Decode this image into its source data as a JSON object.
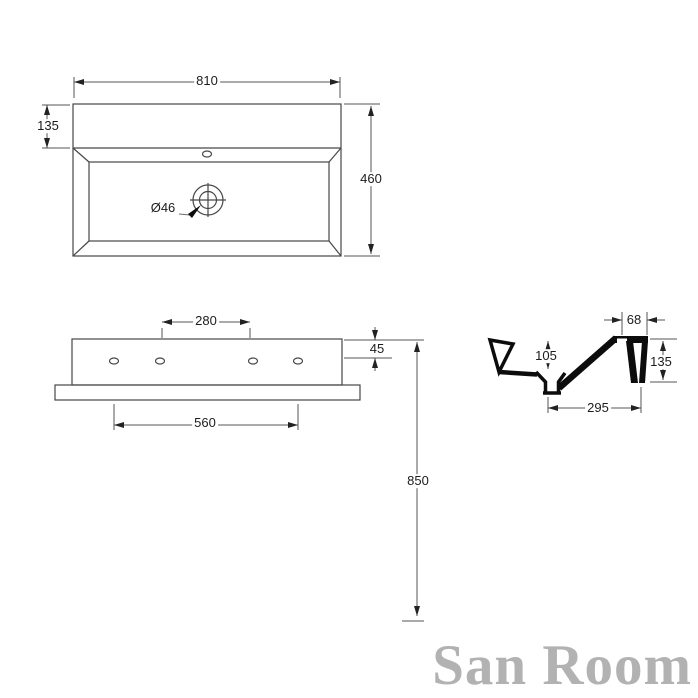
{
  "watermark": "San Room",
  "colors": {
    "thin_line": "#474747",
    "profile": "#0c0c0c",
    "dim_text": "#1c1c1c",
    "watermark": "#b2b2b2"
  },
  "dims": {
    "top": {
      "width": "810",
      "rim": "135",
      "depth": "460",
      "drain": "Ø46"
    },
    "front": {
      "inner_holes": "280",
      "edge": "45",
      "outer_holes": "560"
    },
    "install": {
      "height": "850"
    },
    "side": {
      "ledge": "68",
      "bowl_depth": "105",
      "height": "135",
      "drain_offset": "295"
    }
  }
}
